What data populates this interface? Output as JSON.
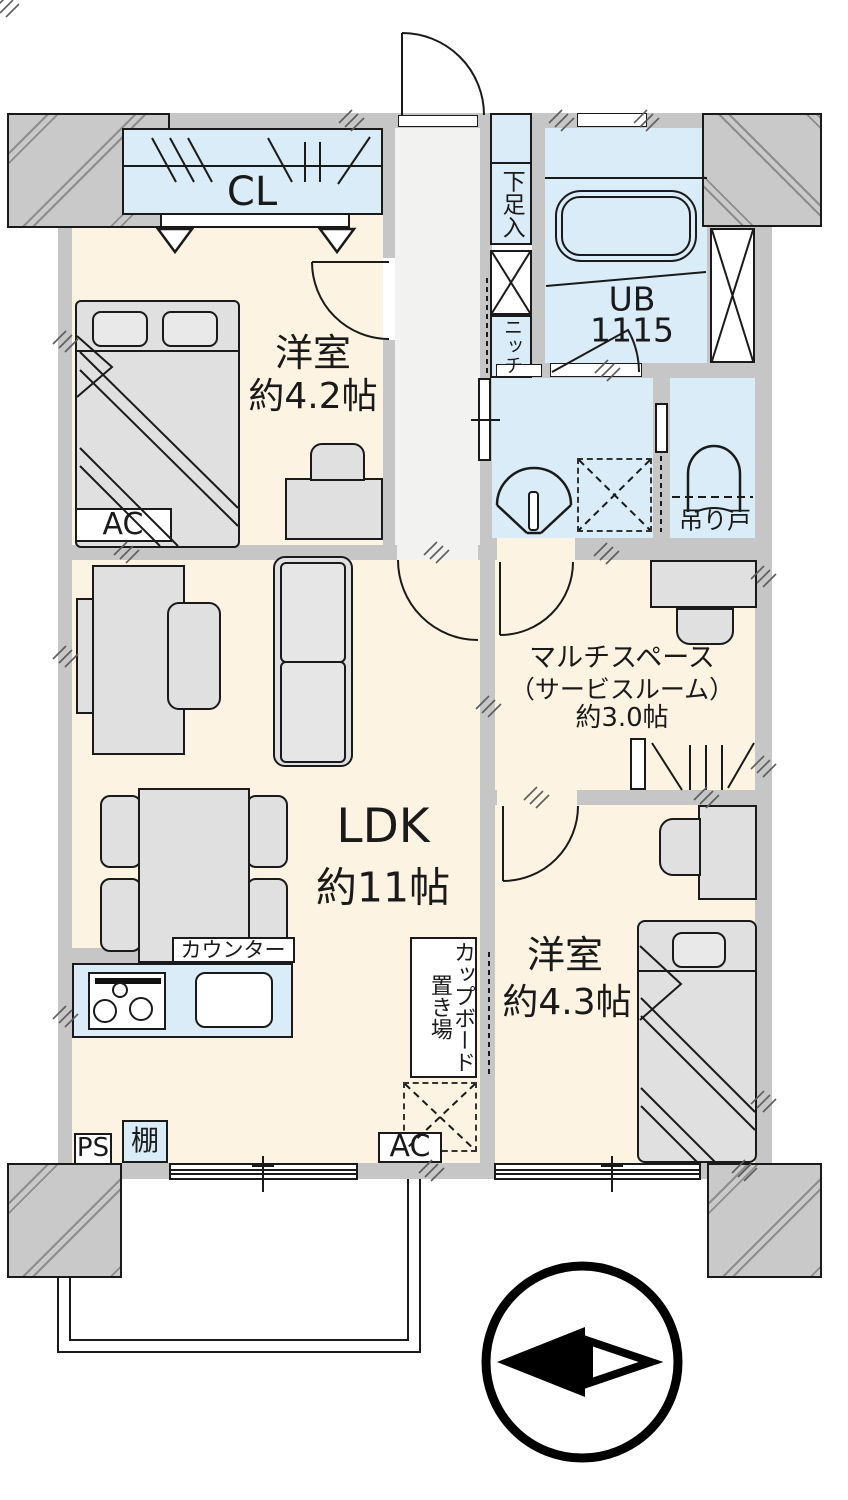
{
  "plan": {
    "rooms": {
      "bedroom1": {
        "name": "洋室",
        "size": "約4.2帖"
      },
      "ldk": {
        "name": "LDK",
        "size": "約11帖"
      },
      "multi": {
        "name": "マルチスペース",
        "name2": "（サービスルーム）",
        "size": "約3.0帖"
      },
      "bedroom2": {
        "name": "洋室",
        "size": "約4.3帖"
      },
      "bath": {
        "name": "UB",
        "size": "1115"
      }
    },
    "fixtures": {
      "closet": "CL",
      "shoe_cabinet": "下足入",
      "niche": "ニッチ",
      "hanging_door": "吊り戸",
      "counter": "カウンター",
      "cupboard": "カップボード置き場",
      "ac_bedroom": "AC",
      "ac_ldk": "AC",
      "pipe_space": "PS",
      "shelf": "棚"
    },
    "colors": {
      "floor": "#fdf3e2",
      "wet": "#daecf8",
      "wall": "#c6c6c6",
      "hall": "#f2f2f0"
    }
  }
}
